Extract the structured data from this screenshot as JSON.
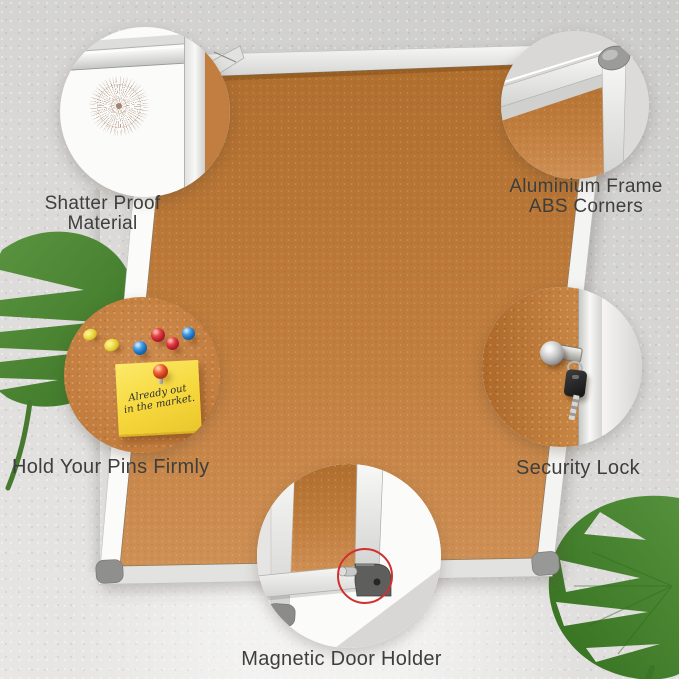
{
  "callouts": {
    "shatter": {
      "line1": "Shatter Proof",
      "line2": "Material"
    },
    "frame": {
      "line1": "Aluminium Frame",
      "line2": "ABS Corners"
    },
    "pins": {
      "label": "Hold Your Pins Firmly",
      "note": {
        "line1": "Already out",
        "line2": "in the market."
      }
    },
    "lock": {
      "label": "Security Lock"
    },
    "magnet": {
      "label": "Magnetic Door Holder"
    }
  },
  "colors": {
    "wall": "#d9d8d6",
    "cork": "#c07c3c",
    "frame_silver": "#efefed",
    "corner_cap_gray": "#8f8f8d",
    "accent_red": "#d03030",
    "note_yellow": "#f5d73a",
    "pin_red": "#c01f2e",
    "pin_blue": "#1c6fb8",
    "pin_yellow": "#e5ce32",
    "pin_orange": "#cc3c1c",
    "leaf_green": "#4a8a33",
    "text": "#3e3e3e"
  },
  "icons": {
    "crack_pattern": "radial-shatter-test",
    "red_highlight": "circle-outline"
  }
}
